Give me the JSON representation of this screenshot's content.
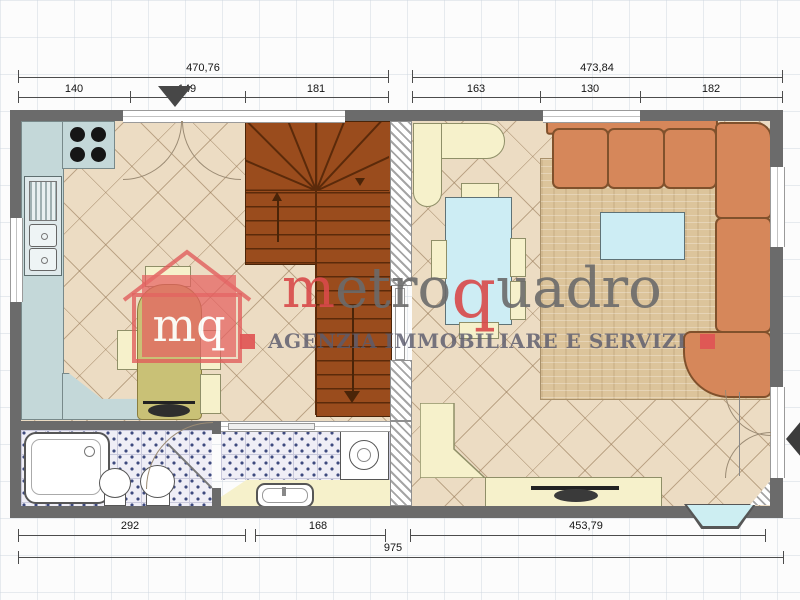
{
  "dimensions": {
    "top_left": {
      "total": "470,76",
      "segments": [
        "140",
        "149",
        "181"
      ]
    },
    "top_right": {
      "total": "473,84",
      "segments": [
        "163",
        "130",
        "182"
      ]
    },
    "bottom": {
      "segments": [
        "292",
        "168",
        "453,79"
      ],
      "total": "975"
    }
  },
  "watermark": {
    "logo_text": "mq",
    "brand": {
      "m": "m",
      "etro": "etro",
      "q": "q",
      "uadro": "uadro"
    },
    "tagline": "AGENZIA IMMOBILIARE E SERVIZI"
  },
  "colors": {
    "wall_gray": "#6b6b6b",
    "floor_beige": "#ecdcc3",
    "kitchen_counter": "#c4d8d9",
    "stairs_brown": "#9a4c1d",
    "sofa_orange": "#d6875a",
    "rug_travertine": "#dcc49b",
    "furniture_cream": "#f6f1cb",
    "table_glass_blue": "#cdedf4",
    "bath_tile": "#efeef6",
    "logo_red": "#e15a5a",
    "brand_red": "#d94a4a",
    "brand_gray": "#6b6b6b"
  }
}
